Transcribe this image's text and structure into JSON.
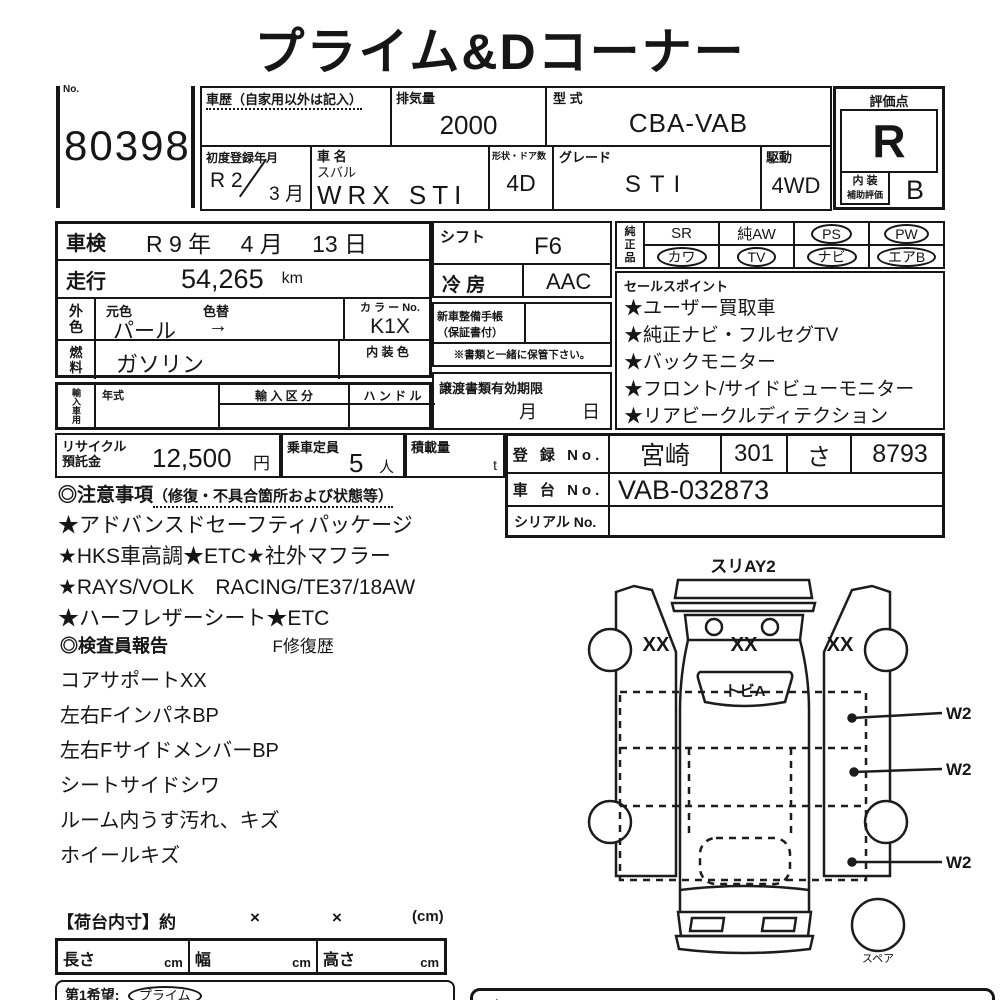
{
  "title": "プライム&Dコーナー",
  "header": {
    "no_label": "No.",
    "auction_no": "80398",
    "history_label": "車歴（自家用以外は記入）",
    "displacement_label": "排気量",
    "displacement": "2000",
    "model_code_label": "型 式",
    "model_code": "CBA-VAB",
    "first_reg_label": "初度登録年月",
    "first_reg_year": "R 2",
    "first_reg_month": "3 月",
    "car_name_label": "車 名",
    "maker": "スバル",
    "car_name": "WRX STI",
    "shape_label": "形状・ドア数",
    "shape": "4D",
    "grade_label": "グレード",
    "grade": "STI",
    "drive_label": "駆動",
    "drive": "4WD",
    "rating_label": "評価点",
    "rating": "R",
    "interior_label_1": "内 装",
    "interior_label_2": "補助評価",
    "interior_rating": "B"
  },
  "left": {
    "shaken_label": "車検",
    "shaken_value": "R 9 年　 4 月　 13 日",
    "mileage_label": "走行",
    "mileage": "54,265",
    "mileage_unit": "km",
    "ext_color_1": "外",
    "ext_color_2": "色",
    "orig_color_label": "元色",
    "color_change_label": "色替",
    "orig_color": "パール",
    "color_change_arrow": "→",
    "color_no_label": "カ ラ ー No.",
    "color_no": "K1X",
    "fuel_1": "燃",
    "fuel_2": "料",
    "fuel": "ガソリン",
    "interior_color_label": "内 装 色",
    "import_label": "輸入車用",
    "year_label": "年式",
    "import_class_label": "輸 入 区 分",
    "handle_label": "ハ ン ド ル"
  },
  "mid": {
    "shift_label": "シフト",
    "shift": "F6",
    "ac_label": "冷 房",
    "ac": "AAC",
    "book_label_1": "新車整備手帳",
    "book_label_2": "（保証書付）",
    "keep_note": "※書類と一緒に保管下さい。",
    "transfer_label": "譲渡書類有効期限",
    "month_char": "月",
    "day_char": "日"
  },
  "equipment": {
    "label_1": "純",
    "label_2": "正",
    "label_3": "品",
    "row1": [
      {
        "label": "SR",
        "circled": false
      },
      {
        "label": "純AW",
        "circled": false
      },
      {
        "label": "PS",
        "circled": true
      },
      {
        "label": "PW",
        "circled": true
      }
    ],
    "row2": [
      {
        "label": "カワ",
        "circled": true
      },
      {
        "label": "TV",
        "circled": true
      },
      {
        "label": "ナビ",
        "circled": true
      },
      {
        "label": "エアB",
        "circled": true
      }
    ]
  },
  "sales": {
    "label": "セールスポイント",
    "items": [
      "★ユーザー買取車",
      "★純正ナビ・フルセグTV",
      "★バックモニター",
      "★フロント/サイドビューモニター",
      "★リアビークルディテクション"
    ]
  },
  "recycle": {
    "label_1": "リサイクル",
    "label_2": "預託金",
    "amount": "12,500",
    "unit": "円",
    "capacity_label": "乗車定員",
    "capacity": "5",
    "capacity_unit": "人",
    "load_label": "積載量",
    "load_unit": "t"
  },
  "registration": {
    "reg_label": "登 録 No.",
    "reg_area": "宮崎",
    "reg_class": "301",
    "reg_kana": "さ",
    "reg_num": "8793",
    "chassis_label": "車 台 No.",
    "chassis": "VAB-032873",
    "serial_label": "シリアル No."
  },
  "notes": {
    "header": "◎注意事項",
    "header_sub": "（修復・不具合箇所および状態等）",
    "items": [
      "★アドバンスドセーフティパッケージ",
      "★HKS車高調★ETC★社外マフラー",
      "★RAYS/VOLK　RACING/TE37/18AW",
      "★ハーフレザーシート★ETC"
    ]
  },
  "report": {
    "header": "◎検査員報告",
    "repair_history": "F修復歴",
    "items": [
      "コアサポートXX",
      "左右FインパネBP",
      "左右FサイドメンバーBP",
      "シートサイドシワ",
      "ルーム内うす汚れ、キズ",
      "ホイールキズ"
    ]
  },
  "diagram": {
    "front_label": "スリAY2",
    "left_mark": "XX",
    "hood_mark": "XX",
    "right_mark": "XX",
    "windshield_mark": "トビA",
    "w2_1": "W2",
    "w2_2": "W2",
    "w2_3": "W2",
    "spare_label": "スペア"
  },
  "cargo": {
    "header": "【荷台内寸】約",
    "x1": "×",
    "x2": "×",
    "unit": "(cm)",
    "length_label": "長さ",
    "length_unit": "cm",
    "width_label": "幅",
    "width_unit": "cm",
    "height_label": "高さ",
    "height_unit": "cm"
  },
  "bottom": {
    "first_choice_label": "第1希望:",
    "first_choice": "プライム",
    "right_box_text": "◆"
  }
}
